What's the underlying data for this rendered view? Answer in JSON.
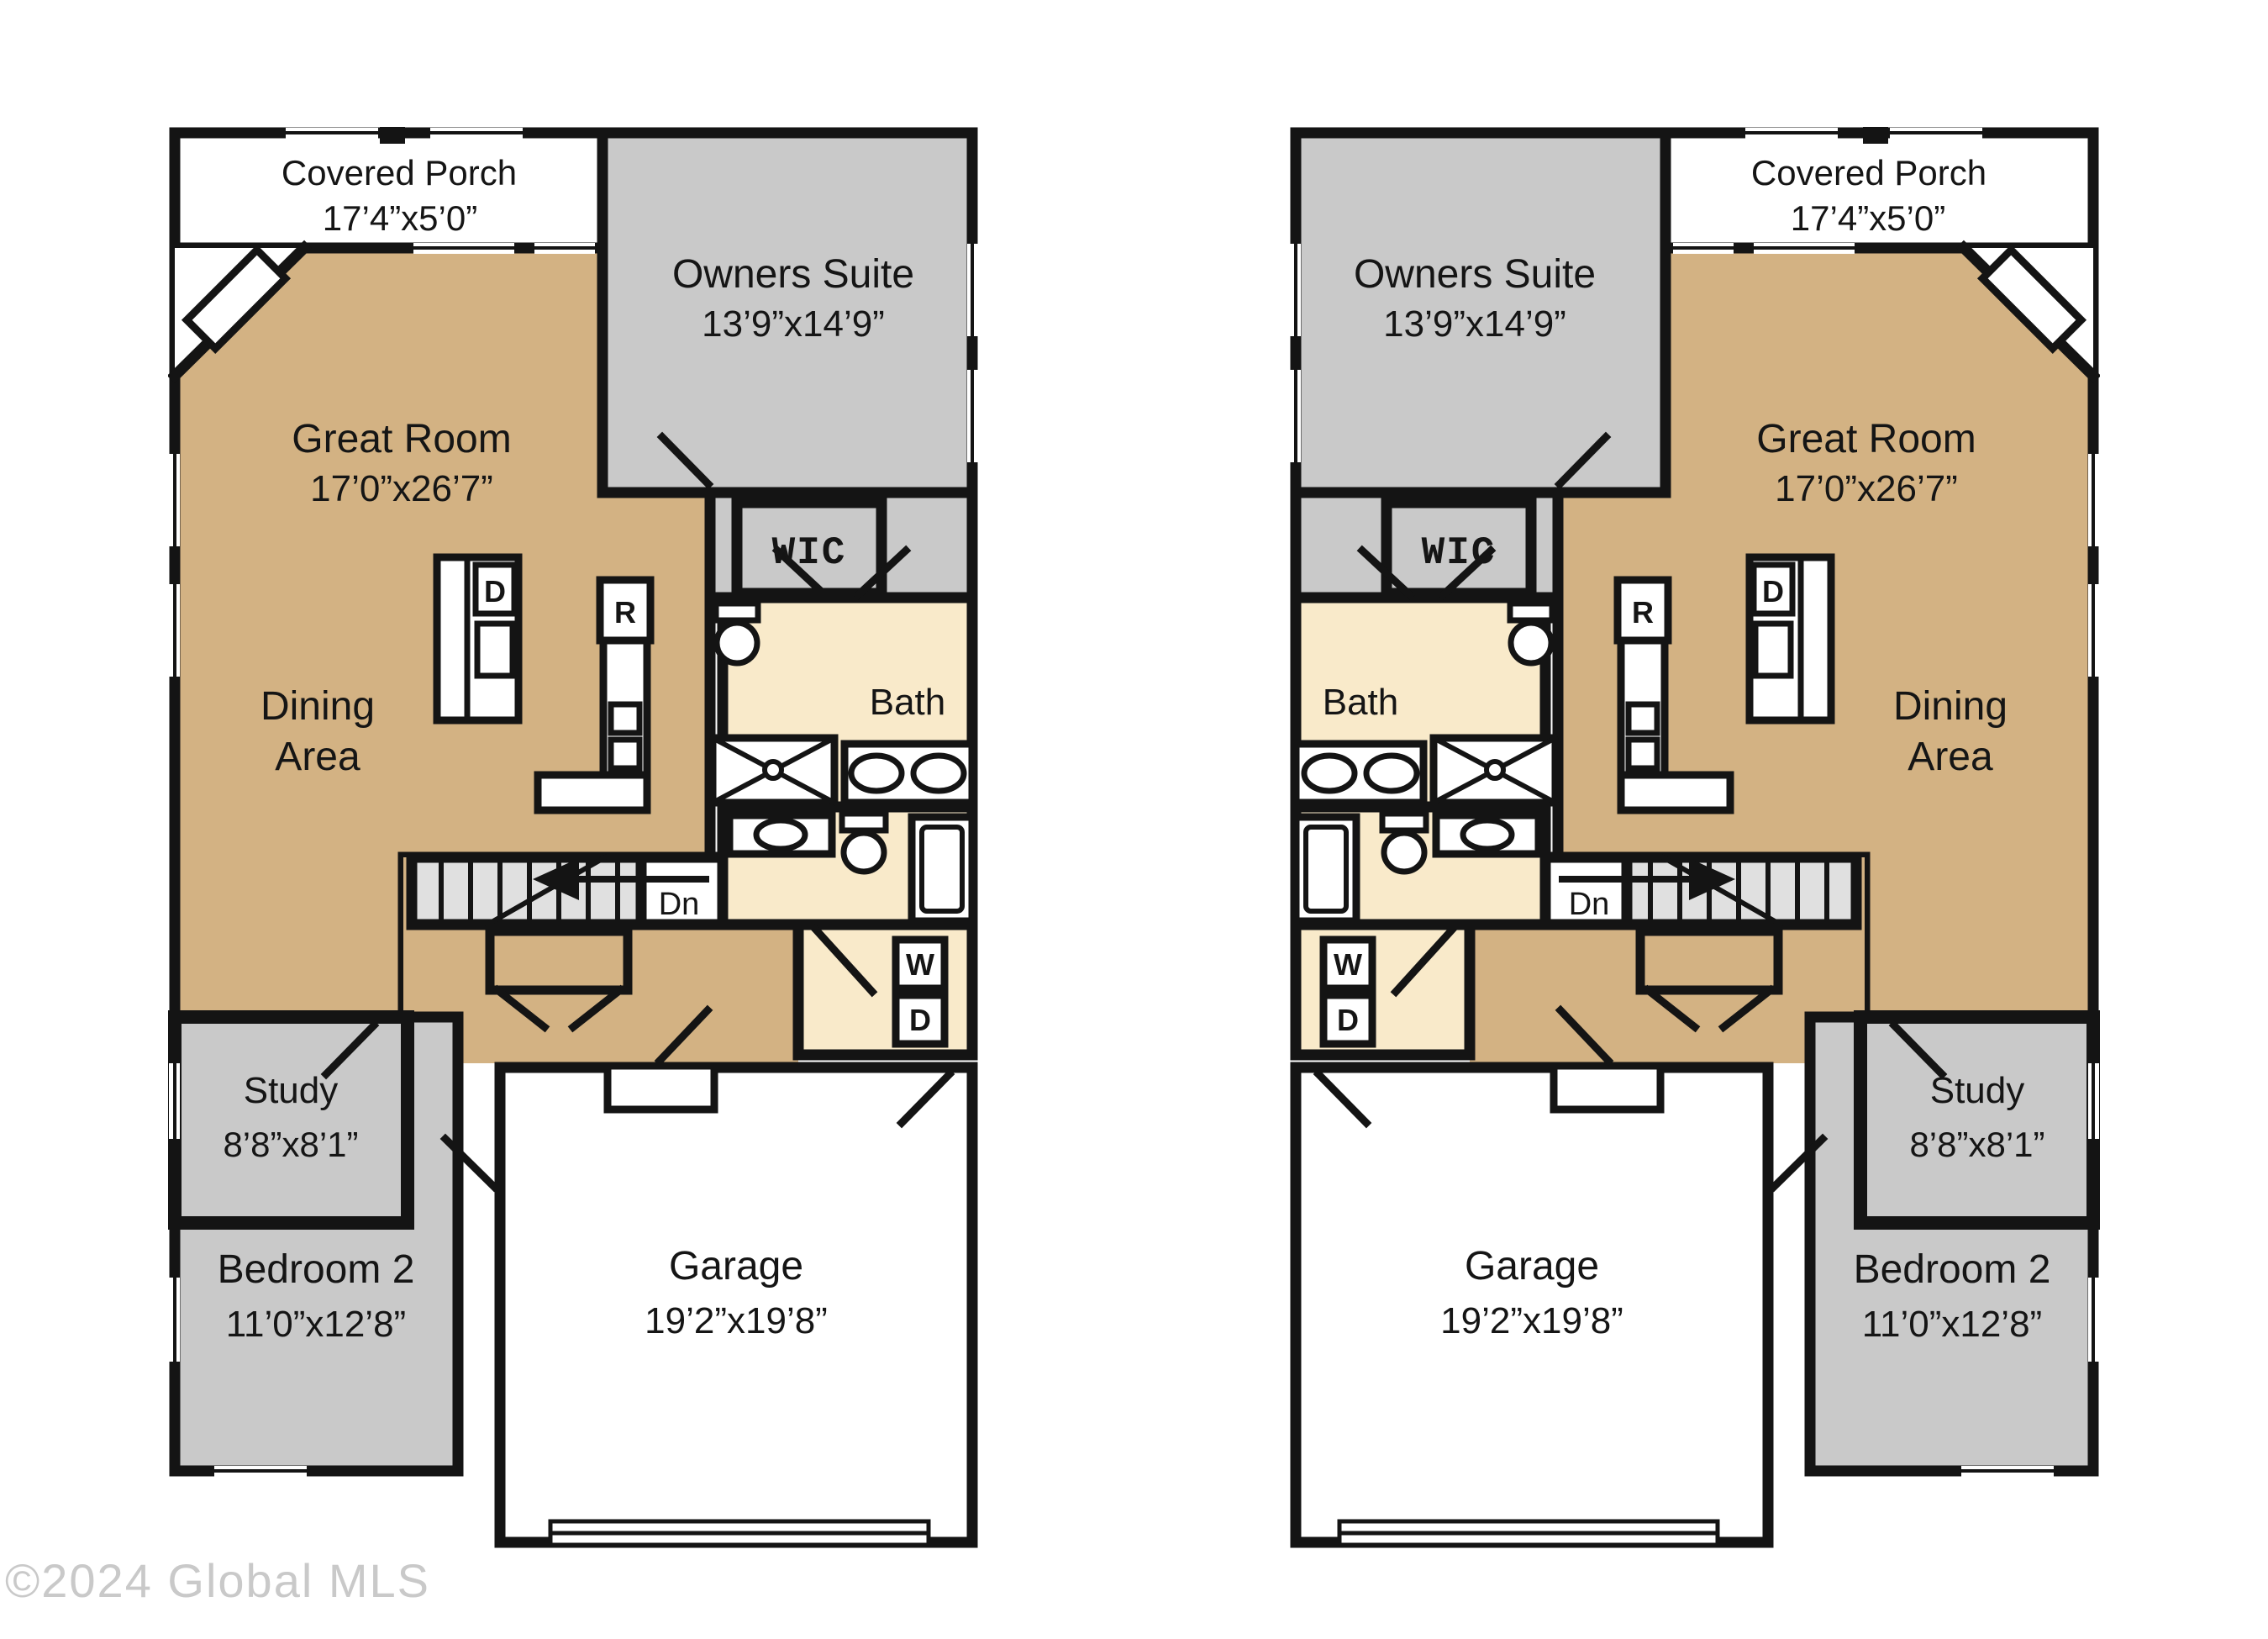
{
  "page": {
    "background": "#ffffff",
    "copyright": "©2024 Global MLS"
  },
  "palette": {
    "wall": "#141414",
    "floor_tan": "#D3B283",
    "room_gray": "#C9C9C9",
    "bath_cream": "#F9EACA",
    "white": "#FFFFFF"
  },
  "units": [
    {
      "id": "left",
      "mirrored": false
    },
    {
      "id": "right",
      "mirrored": true
    }
  ],
  "rooms": {
    "covered_porch": {
      "label": "Covered Porch",
      "dims": "17’4”x5’0”"
    },
    "owners_suite": {
      "label": "Owners Suite",
      "dims": "13’9”x14’9”"
    },
    "great_room": {
      "label": "Great Room",
      "dims": "17’0”x26’7”"
    },
    "dining_area": {
      "line1": "Dining",
      "line2": "Area"
    },
    "wic": {
      "label": "WIC"
    },
    "bath": {
      "label": "Bath"
    },
    "stairs": {
      "label": "Dn"
    },
    "study": {
      "label": "Study",
      "dims": "8’8”x8’1”"
    },
    "bedroom_2": {
      "label": "Bedroom 2",
      "dims": "11’0”x12’8”"
    },
    "garage": {
      "label": "Garage",
      "dims": "19’2”x19’8”"
    }
  },
  "appliances": {
    "range": "R",
    "dishwasher": "D",
    "washer": "W",
    "dryer": "D"
  }
}
